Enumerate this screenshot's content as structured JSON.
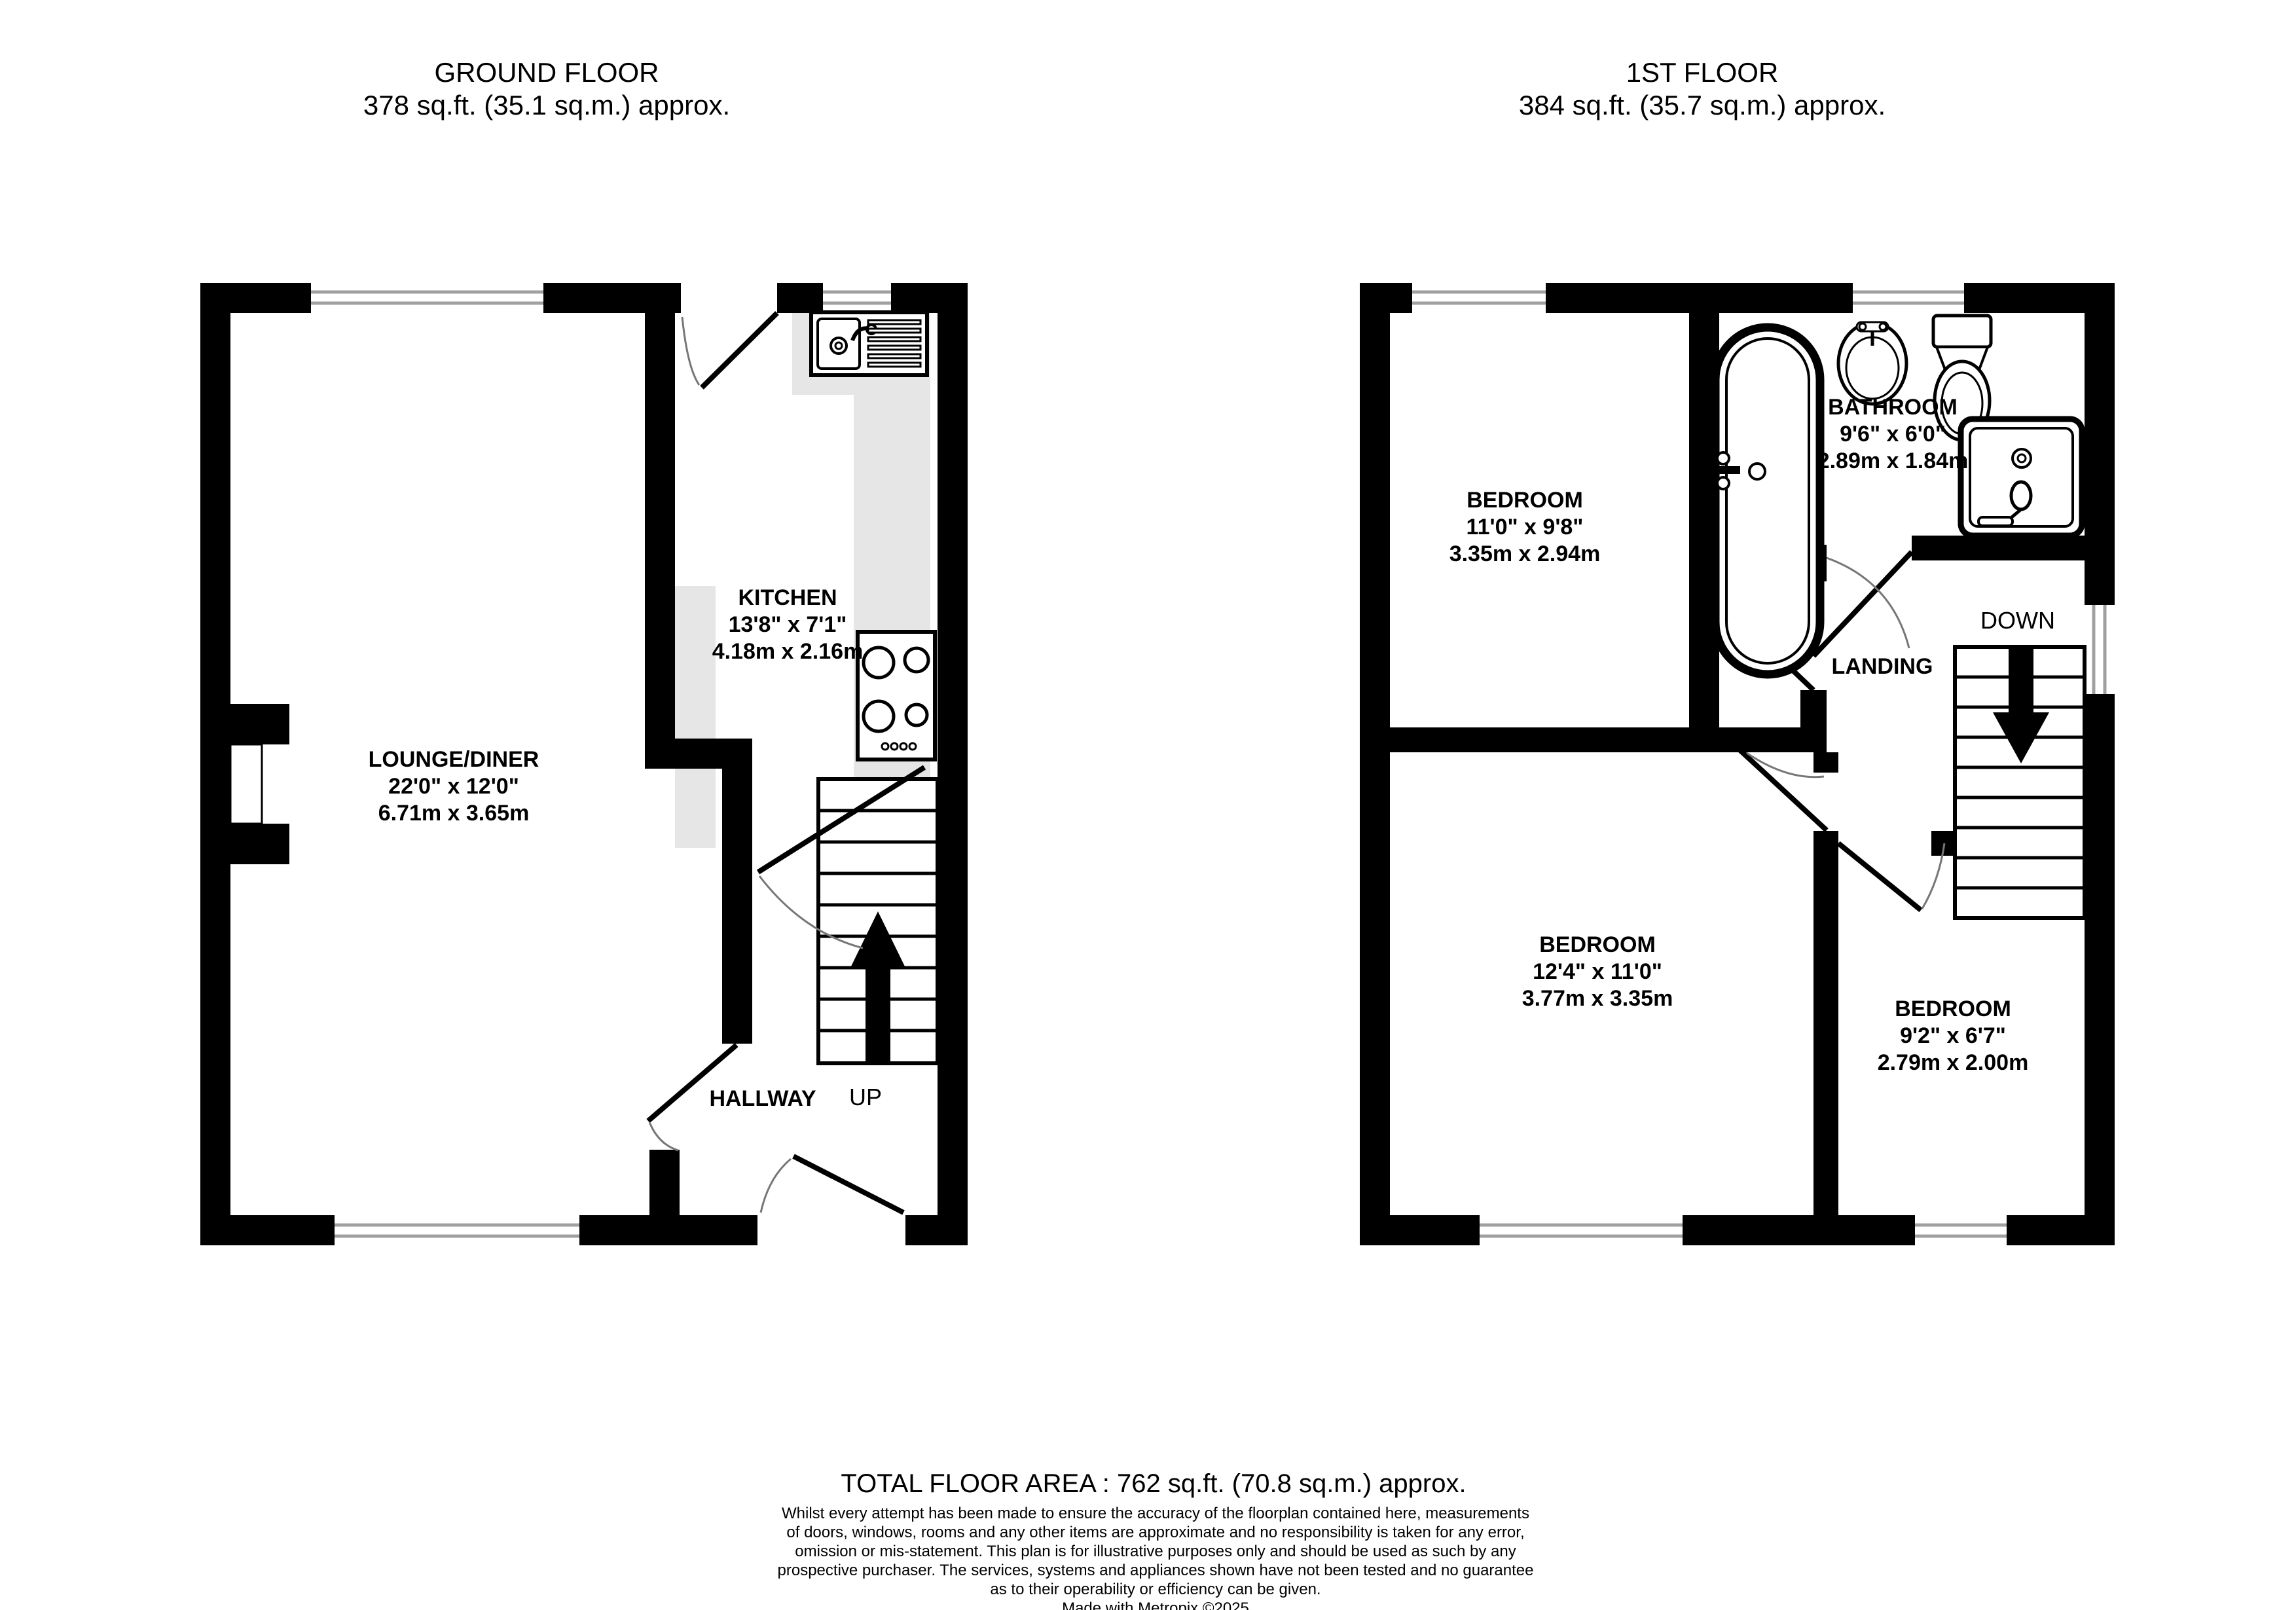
{
  "ground_floor": {
    "title": "GROUND FLOOR",
    "area": "378 sq.ft. (35.1 sq.m.) approx.",
    "rooms": {
      "lounge": {
        "name": "LOUNGE/DINER",
        "imperial": "22'0\"  x 12'0\"",
        "metric": "6.71m  x 3.65m"
      },
      "kitchen": {
        "name": "KITCHEN",
        "imperial": "13'8\"  x 7'1\"",
        "metric": "4.18m  x 2.16m"
      },
      "hallway": {
        "name": "HALLWAY"
      }
    },
    "stairs_label": "UP"
  },
  "first_floor": {
    "title": "1ST FLOOR",
    "area": "384 sq.ft. (35.7 sq.m.) approx.",
    "rooms": {
      "bedroom1": {
        "name": "BEDROOM",
        "imperial": "11'0\"  x 9'8\"",
        "metric": "3.35m  x 2.94m"
      },
      "bathroom": {
        "name": "BATHROOM",
        "imperial": "9'6\"  x 6'0\"",
        "metric": "2.89m  x 1.84m"
      },
      "landing": {
        "name": "LANDING"
      },
      "bedroom2": {
        "name": "BEDROOM",
        "imperial": "12'4\"  x 11'0\"",
        "metric": "3.77m  x 3.35m"
      },
      "bedroom3": {
        "name": "BEDROOM",
        "imperial": "9'2\"  x 6'7\"",
        "metric": "2.79m  x 2.00m"
      }
    },
    "stairs_label": "DOWN"
  },
  "footer": {
    "total": "TOTAL FLOOR AREA : 762 sq.ft. (70.8 sq.m.) approx.",
    "disclaimer_lines": [
      "Whilst every attempt has been made to ensure the accuracy of the floorplan contained here, measurements",
      "of doors, windows, rooms and any other items are approximate and no responsibility is taken for any error,",
      "omission or mis-statement. This plan is for illustrative purposes only and should be used as such by any",
      "prospective purchaser. The services, systems and appliances shown have not been tested and no guarantee",
      "as to their operability or efficiency can be given."
    ],
    "credit": "Made with Metropix ©2025"
  },
  "colors": {
    "wall": "#000000",
    "counter": "#e6e6e6",
    "window_line": "#a0a0a0",
    "door_arc": "#777777",
    "background": "#ffffff"
  }
}
